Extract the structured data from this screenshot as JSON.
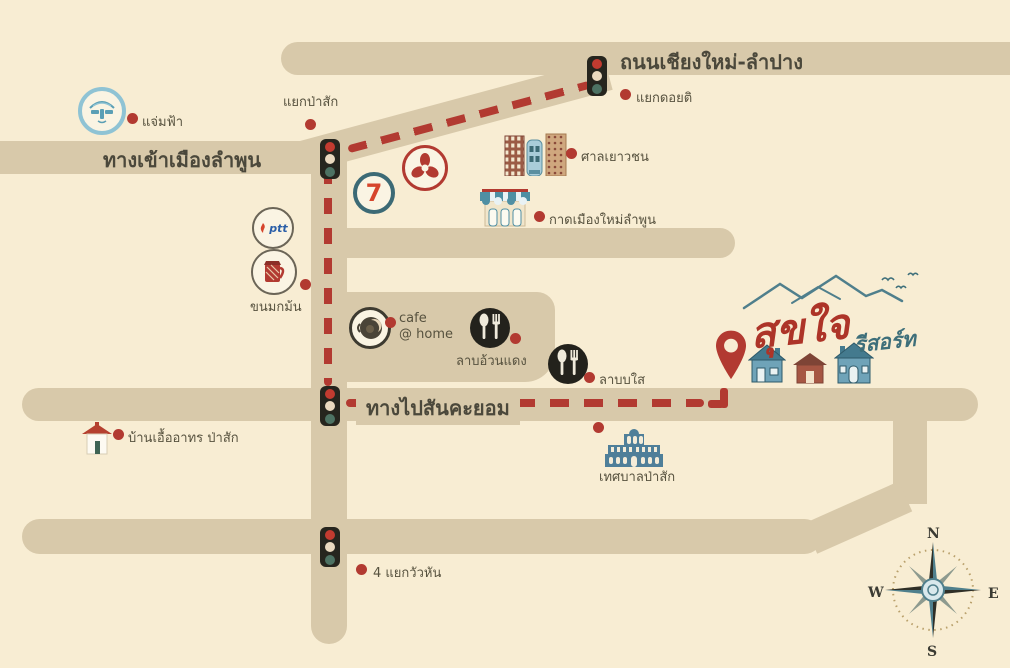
{
  "colors": {
    "background": "#f8edd3",
    "road": "#d8c9aa",
    "route": "#b23a31",
    "teal": "#3e6f7a"
  },
  "roads": {
    "top": {
      "label": "ถนนเชียงใหม่-ลำปาง"
    },
    "west": {
      "label": "ทางเข้าเมืองลำพูน"
    },
    "main": {
      "label": "ทางไปสันคะยอม"
    }
  },
  "markers": {
    "jaemfah": {
      "label": "แจ่มฟ้า"
    },
    "yak_pasak": {
      "label": "แยกป่าสัก"
    },
    "yak_doiti": {
      "label": "แยกดอยติ"
    },
    "juvenile_court": {
      "label": "ศาลเยาวชน"
    },
    "market": {
      "label": "กาดเมืองใหม่ลำพูน"
    },
    "dessert_shop": {
      "label": "ขนมกม้น"
    },
    "cafe": {
      "line1": "cafe",
      "line2": "@ home"
    },
    "laab_uan_daeng": {
      "label": "ลาบอ้วนแดง"
    },
    "laab_sai": {
      "label": "ลาบบใส"
    },
    "baan_uea_arthorn": {
      "label": "บ้านเอื้ออาทร ป่าสัก"
    },
    "pasak_municipality": {
      "label": "เทศบาลป่าสัก"
    },
    "wua_hin_intersection": {
      "label": "4 แยกวัวหัน"
    }
  },
  "brands": {
    "seven_eleven": "7",
    "ptt": "ptt"
  },
  "resort": {
    "name": "สุขใจ",
    "suffix": "รีสอร์ท"
  },
  "compass": {
    "north": "N",
    "east": "E",
    "south": "S",
    "west": "W"
  }
}
